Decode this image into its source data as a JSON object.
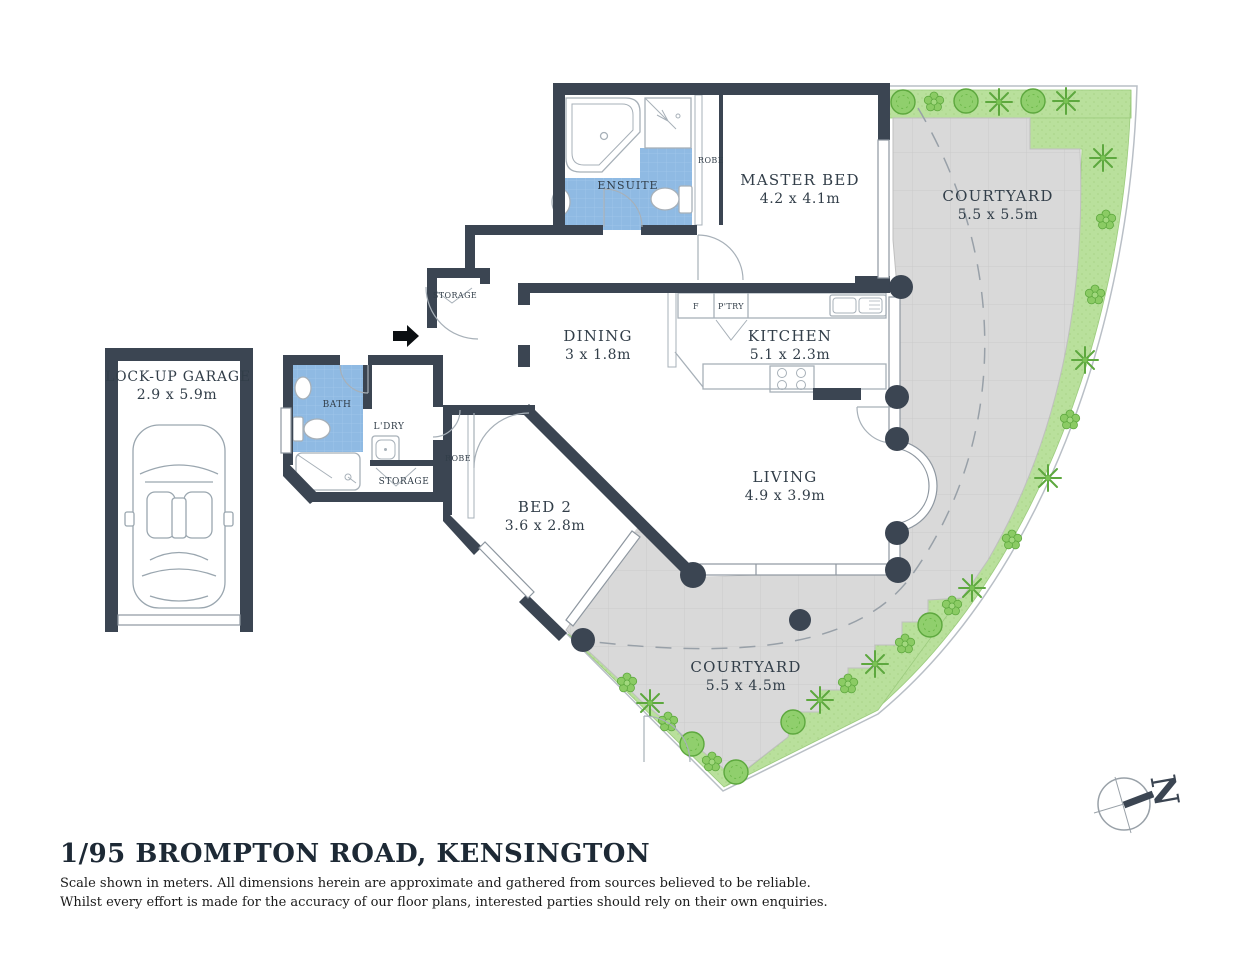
{
  "title": "1/95 BROMPTON ROAD, KENSINGTON",
  "disclaimer": {
    "line1": "Scale shown in meters. All dimensions herein are approximate and gathered from sources believed to be  reliable.",
    "line2": "Whilst every effort is made for the accuracy of our floor plans, interested parties should rely on their own enquiries."
  },
  "compass": {
    "letter": "N"
  },
  "plan": {
    "garage": {
      "name": "LOCK-UP GARAGE",
      "dims": "2.9 x 5.9m"
    },
    "master_bed": {
      "name": "MASTER BED",
      "dims": "4.2 x 4.1m"
    },
    "ensuite": {
      "name": "ENSUITE"
    },
    "master_robe": {
      "name": "ROBE"
    },
    "courtyard_ne": {
      "name": "COURTYARD",
      "dims": "5.5 x 5.5m"
    },
    "dining": {
      "name": "DINING",
      "dims": "3 x 1.8m"
    },
    "kitchen": {
      "name": "KITCHEN",
      "dims": "5.1 x 2.3m"
    },
    "fridge": {
      "name": "F"
    },
    "pantry": {
      "name": "P'TRY"
    },
    "entry_storage": {
      "name": "STORAGE"
    },
    "bath": {
      "name": "BATH"
    },
    "laundry": {
      "name": "L'DRY"
    },
    "hall_storage": {
      "name": "STORAGE"
    },
    "bed2": {
      "name": "BED 2",
      "dims": "3.6 x 2.8m"
    },
    "bed2_robe": {
      "name": "ROBE"
    },
    "living": {
      "name": "LIVING",
      "dims": "4.9 x 3.9m"
    },
    "courtyard_s": {
      "name": "COURTYARD",
      "dims": "5.5 x 4.5m"
    }
  },
  "colors": {
    "wall": "#3B4552",
    "wet_area_tile": "#8FBAE3",
    "garden": "#B9E09C",
    "plant": "#6AB74A",
    "paving": "#D9D9D9",
    "fixture_line": "#A7B0B8",
    "text": "#323E49"
  }
}
